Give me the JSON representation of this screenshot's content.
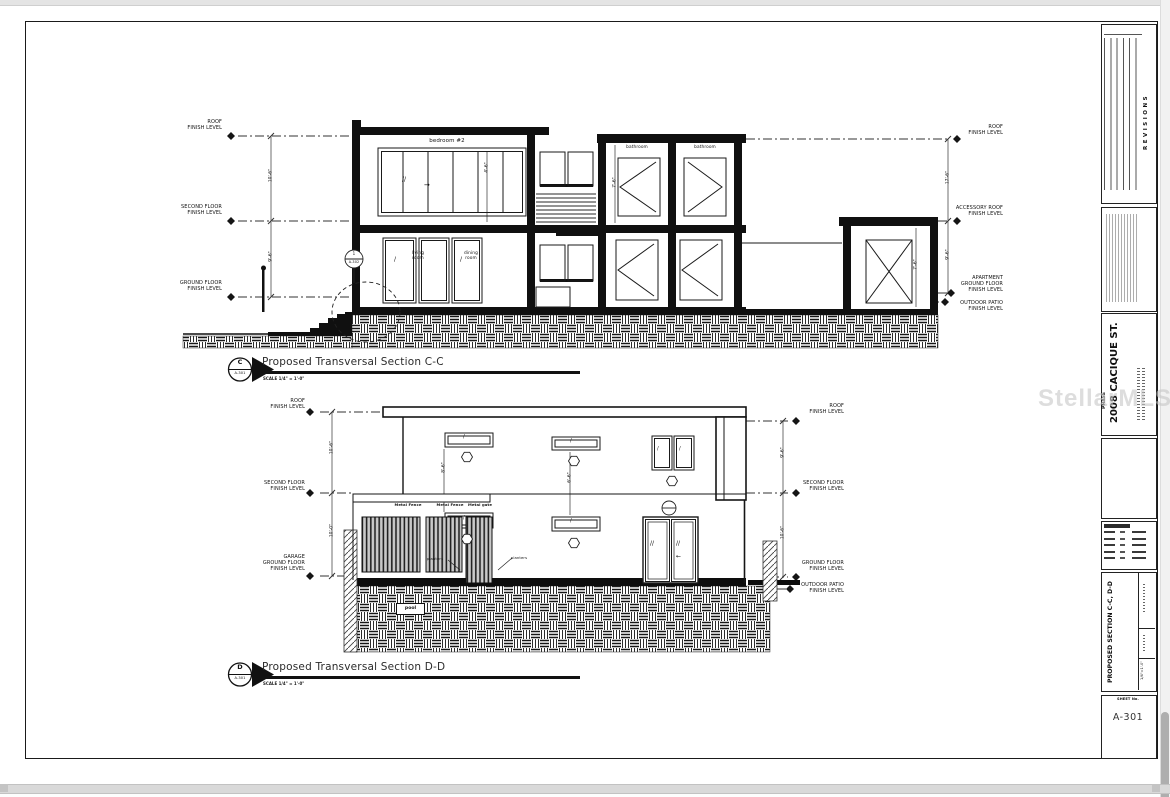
{
  "watermark": "StellarMLS",
  "glyphs": {
    "slash": "/",
    "double_slash": "//",
    "arrow_right": "→",
    "arrow_left": "←"
  },
  "cc": {
    "title": "Proposed Transversal Section C-C",
    "scale_note": "SCALE 1/4\" = 1'-0\"",
    "marker": {
      "letter": "C",
      "sheet": "A-301"
    },
    "callout": {
      "num": "1",
      "sheet": "A-302"
    },
    "levels_left": {
      "roof": "ROOF\nFINISH LEVEL",
      "second": "SECOND FLOOR\nFINISH LEVEL",
      "ground": "GROUND FLOOR\nFINISH LEVEL"
    },
    "levels_right": {
      "roof": "ROOF\nFINISH LEVEL",
      "accessory_roof": "ACCESSORY ROOF\nFINISH LEVEL",
      "apartment_ground": "APARTMENT\nGROUND FLOOR\nFINISH LEVEL",
      "outdoor_patio": "OUTDOOR PATIO\nFINISH LEVEL"
    },
    "rooms": {
      "bedroom": "bedroom #2",
      "living": "living\nroom",
      "dining": "dining\nroom",
      "bath_ul": "bathroom",
      "bath_ur": "bathroom",
      "bath_ll": "bathroom",
      "bath_lr": "bathroom"
    },
    "dims": {
      "left_upper": "10'-6\"",
      "left_lower": "9'-6\"",
      "right_upper": "17'-6\"",
      "right_lower": "9'-6\"",
      "int_bedroom": "4'-6\"",
      "int_bath": "7'-6\"",
      "int_accessory": "7'-6\""
    }
  },
  "dd": {
    "title": "Proposed Transversal Section D-D",
    "scale_note": "SCALE 1/4\" = 1'-0\"",
    "marker": {
      "letter": "D",
      "sheet": "A-301"
    },
    "levels_left": {
      "roof": "ROOF\nFINISH LEVEL",
      "second": "SECOND FLOOR\nFINISH LEVEL",
      "garage": "GARAGE\nGROUND FLOOR\nFINISH LEVEL"
    },
    "levels_right": {
      "roof": "ROOF\nFINISH LEVEL",
      "second": "SECOND FLOOR\nFINISH LEVEL",
      "ground": "GROUND FLOOR\nFINISH LEVEL",
      "outdoor_patio": "OUTDOOR PATIO\nFINISH LEVEL"
    },
    "features": {
      "fence1": "Metal Fence",
      "fence2": "Metal Fence",
      "gate": "Metal gate",
      "planters1": "planters",
      "planters2": "planters",
      "pool": "pool"
    },
    "dims": {
      "left_upper": "10'-6\"",
      "left_lower": "10'-0\"",
      "right_upper": "9'-6\"",
      "right_lower": "10'-6\"",
      "int_a": "8'-6\"",
      "int_b": "6'-6\""
    }
  },
  "title_block": {
    "revisions": "REVISIONS",
    "phase": "PHASE",
    "project": "2008 CACIQUE ST.",
    "sheet_title": "PROPOSED SECTION C-C, D-D",
    "scale_value": "1/4\"=1'-0\"",
    "sheet_no_label": "SHEET No.",
    "sheet_no": "A-301"
  }
}
